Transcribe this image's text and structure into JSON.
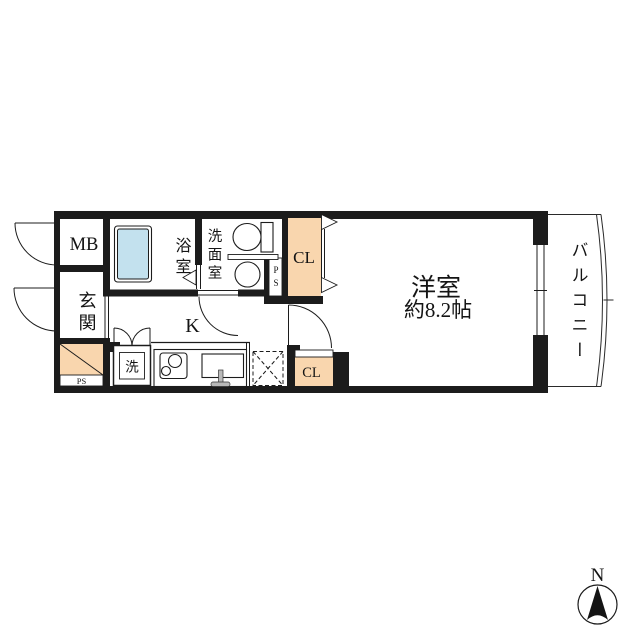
{
  "floor_plan": {
    "rooms": {
      "meter_box": "MB",
      "entrance": "玄関",
      "bathroom": "浴室",
      "washroom": "洗面室",
      "closet_upper": "CL",
      "closet_lower": "CL",
      "kitchen": "K",
      "western_room": "洋室",
      "western_room_size": "約8.2帖",
      "balcony": "バルコニー"
    },
    "annotations": {
      "washer": "洗",
      "pipe_space_upper": "PS",
      "pipe_space_lower": "PS"
    },
    "compass": {
      "north": "N"
    },
    "colors": {
      "wall": "#1c1c1c",
      "closet_fill": "#f9d6ae",
      "bathtub_fill": "#c3e1ee"
    }
  }
}
